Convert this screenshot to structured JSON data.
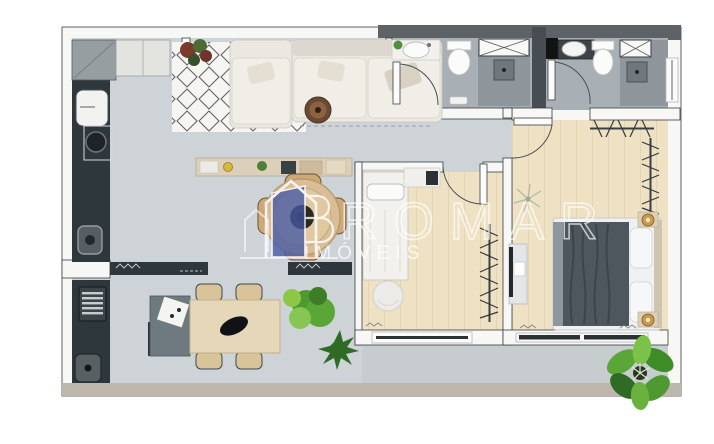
{
  "watermark": {
    "brand": "ROMAR",
    "subtitle": "IMÓVEIS",
    "logo": "house-door-logo"
  },
  "colors": {
    "bg": "#ffffff",
    "wallFill": "#f7f7f5",
    "wallLine": "#383d41",
    "darkBand": "#5d6266",
    "shaft": "#474d52",
    "floorLiving": "#cdd3d6",
    "floorBath": "#a9b0b5",
    "floorShower": "#8e969c",
    "floorWood": "#efe2c4",
    "floorTerrace": "#c7ccce",
    "bottomWall": "#bdb7ae",
    "counterDark": "#2e373c",
    "counterBeige": "#ddd0ba",
    "sofa": "#ebe8e1",
    "cushion": "#f1eee7",
    "rugBg": "#f6f5f1",
    "rugLine": "#3b3f42",
    "sideTableWood": "#6b4a33",
    "tableWood": "#d9bd97",
    "chairWood": "#cfa878",
    "diningWood": "#e6d7b8",
    "sideboard": "#6f7a80",
    "plantGreen": "#5aa636",
    "plantDark": "#2f6b25",
    "plantLime": "#8cc845",
    "plantRust": "#7a3b2e",
    "bedBlanket": "#4e575e",
    "bedSheet": "#eef0f2",
    "lampGold": "#c99a4e",
    "appliance": "#f2f2f0",
    "fixture": "#fbfbf9",
    "glassLine": "#3a3e41",
    "doorArc": "#4a4f53",
    "watermark": "#ffffff",
    "logoBlue": "#4558a4"
  },
  "plan_icons": [
    "sofa-icon",
    "rug-icon",
    "round-side-table-icon",
    "entry-door-icon",
    "washing-machine-icon",
    "laundry-sink-icon",
    "kitchen-counter-icon",
    "kitchen-sink-icon",
    "cooktop-icon",
    "round-dining-table-icon",
    "dining-chair-icon",
    "dining-table-icon",
    "sideboard-icon",
    "plant-icon",
    "bbq-grill-icon",
    "balcony-sink-icon",
    "single-bed-icon",
    "desk-tv-icon",
    "pouf-icon",
    "clothes-rack-icon",
    "double-bed-icon",
    "nightstand-lamp-icon",
    "tv-console-icon",
    "bathroom-sink-icon",
    "toilet-icon",
    "shower-icon",
    "shower-glass-icon",
    "window-icon",
    "sliding-door-icon",
    "door-swing-icon"
  ]
}
